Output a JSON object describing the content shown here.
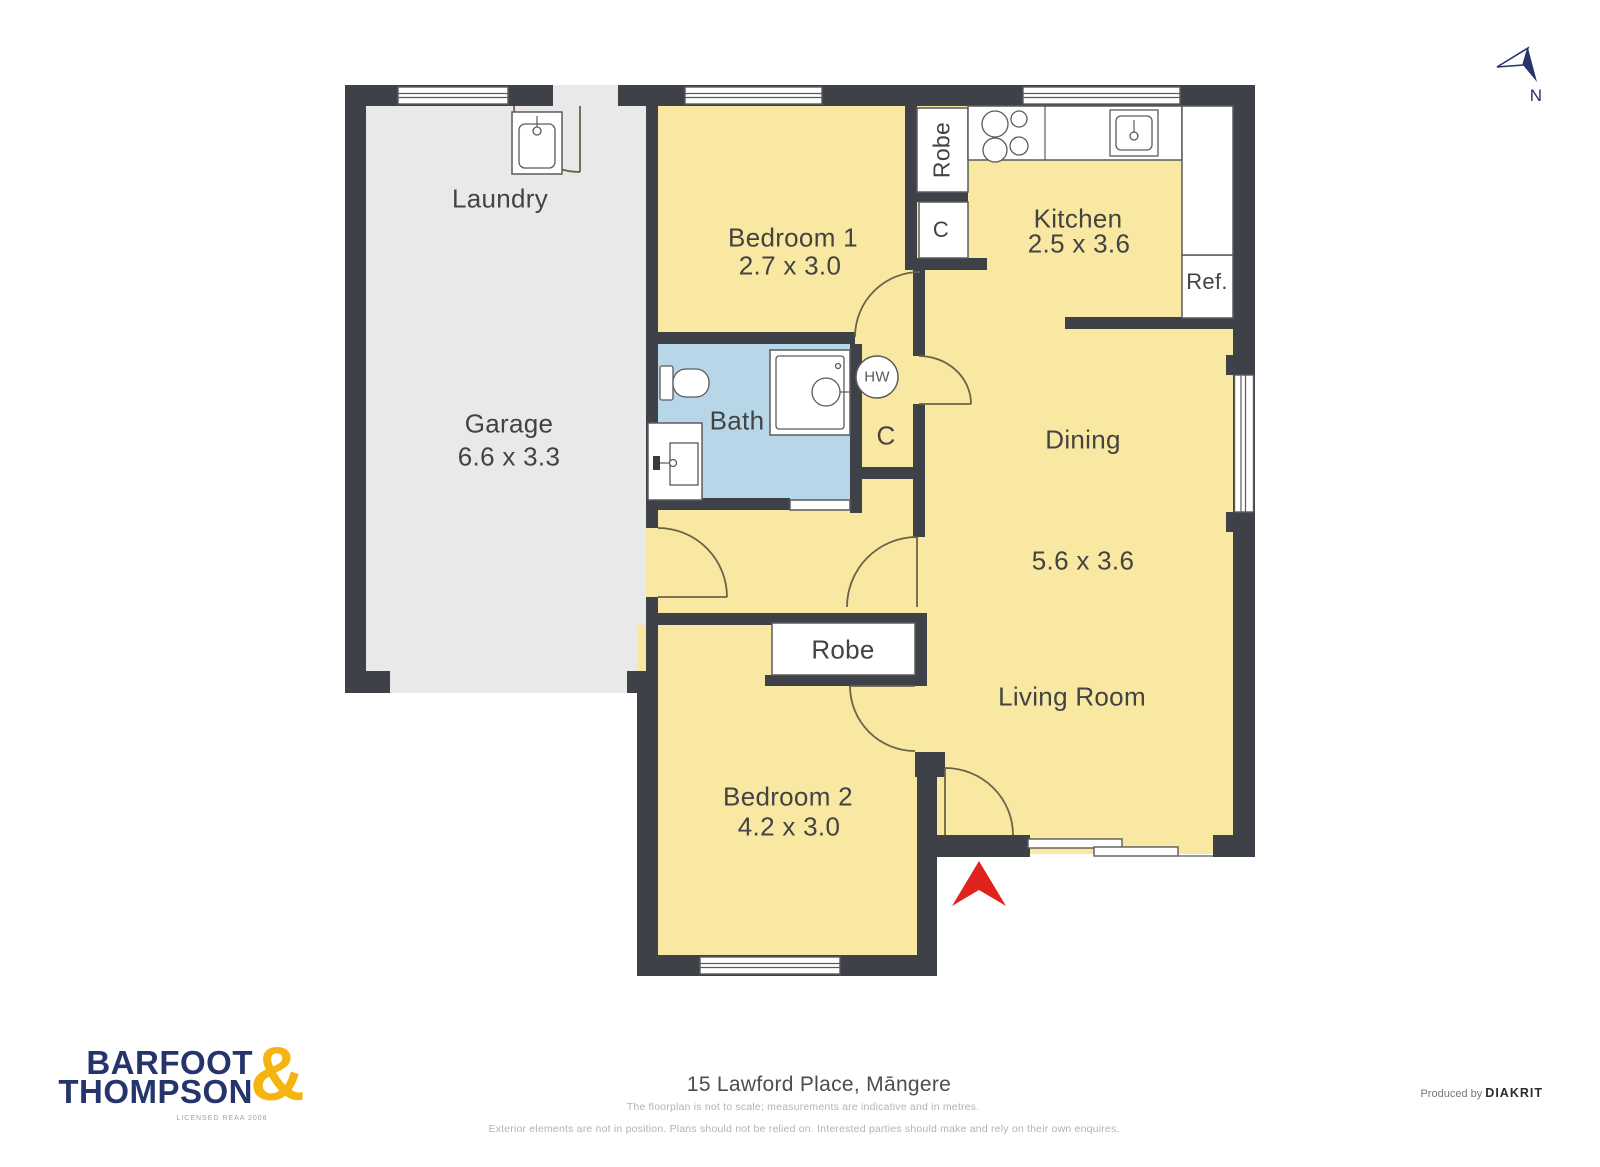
{
  "colors": {
    "wall": "#3e4147",
    "floor-yellow": "#f8e8a1",
    "floor-grey": "#e9e9ea",
    "floor-blue": "#b7d6e7",
    "line": "#5a5b5e",
    "door": "#6b6348",
    "entry-red": "#e0231d",
    "brand-navy": "#25356b",
    "brand-yellow": "#f6b410"
  },
  "rooms": {
    "laundry": {
      "label": "Laundry"
    },
    "garage": {
      "label": "Garage",
      "dims": "6.6 x 3.3"
    },
    "bedroom1": {
      "label": "Bedroom 1",
      "dims": "2.7 x 3.0"
    },
    "kitchen": {
      "label": "Kitchen",
      "dims": "2.5 x 3.6"
    },
    "dining": {
      "label": "Dining"
    },
    "living": {
      "label": "Living Room"
    },
    "dining_living_dims": "5.6 x 3.6",
    "bedroom2": {
      "label": "Bedroom 2",
      "dims": "4.2 x 3.0"
    },
    "bath": {
      "label": "Bath"
    }
  },
  "closets": {
    "robe_top": "Robe",
    "cupboard_top": "C",
    "fridge": "Ref.",
    "hot_water": "HW",
    "cupboard_hall": "C",
    "robe_bedroom2": "Robe"
  },
  "compass": {
    "north": "N"
  },
  "footer": {
    "address": "15 Lawford Place, Māngere",
    "disclaimer_line1": "The floorplan is not to scale; measurements are indicative and in metres.",
    "disclaimer_line2": "Exterior elements are not in position. Plans should not be relied on. Interested parties should make and rely on their own enquires.",
    "produced_by": "Produced by",
    "producer": "DIAKRIT"
  },
  "logo": {
    "word1": "BARFOOT",
    "word2": "THOMPSON",
    "ampersand": "&",
    "licence": "LICENSED REAA 2008"
  }
}
